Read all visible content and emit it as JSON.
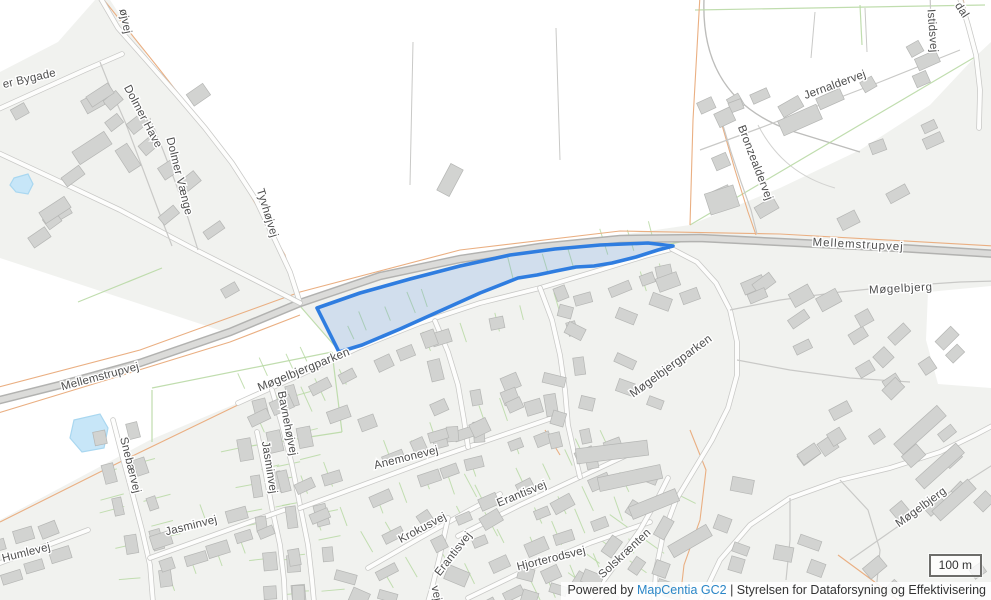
{
  "map": {
    "highlight": {
      "stroke_color": "#2f7de0",
      "fill_color": "rgba(51,122,230,0.17)",
      "polygon": [
        [
          317,
          308
        ],
        [
          360,
          293
        ],
        [
          410,
          279
        ],
        [
          460,
          266
        ],
        [
          510,
          255
        ],
        [
          555,
          249
        ],
        [
          600,
          245
        ],
        [
          648,
          243
        ],
        [
          673,
          246
        ],
        [
          658,
          250
        ],
        [
          636,
          257
        ],
        [
          612,
          263
        ],
        [
          594,
          266
        ],
        [
          576,
          267
        ],
        [
          556,
          271
        ],
        [
          537,
          275
        ],
        [
          518,
          278
        ],
        [
          480,
          293
        ],
        [
          440,
          311
        ],
        [
          400,
          329
        ],
        [
          362,
          345
        ],
        [
          339,
          352
        ]
      ]
    },
    "palette": {
      "background": "#f1f2ef",
      "field": "#ffffff",
      "building_fill": "#d2d3d1",
      "building_stroke": "#b5b6b4",
      "road_major_fill": "#dbdbd9",
      "road_major_casing": "#b2b2b0",
      "road_minor_casing": "#c8c8c6",
      "hedge_green": "#b9d9a5",
      "path_orange": "#eaaf82",
      "water_fill": "#c7e6f8",
      "water_stroke": "#a9d7f0",
      "label_color": "#4e4e4e"
    },
    "labels": [
      {
        "text": "øjvej",
        "x": 122,
        "y": 22,
        "r": 78,
        "s": 11.5
      },
      {
        "text": "er Bygade",
        "x": 30,
        "y": 82,
        "r": -13,
        "s": 11.5
      },
      {
        "text": "Dolmer Have",
        "x": 140,
        "y": 118,
        "r": 62,
        "s": 11.5
      },
      {
        "text": "Dolmer Vænge",
        "x": 176,
        "y": 177,
        "r": 76,
        "s": 11.5
      },
      {
        "text": "Tyvhøjvej",
        "x": 264,
        "y": 214,
        "r": 73,
        "s": 11.5
      },
      {
        "text": "Mellemstrupvej",
        "x": 101,
        "y": 380,
        "r": -15,
        "s": 11.5
      },
      {
        "text": "Mellemstrupvej",
        "x": 858,
        "y": 248,
        "r": 3,
        "s": 11.5,
        "ls": 1
      },
      {
        "text": "Møgelbjergparken",
        "x": 305,
        "y": 373,
        "r": -22,
        "s": 11.8
      },
      {
        "text": "Møgelbjergparken",
        "x": 673,
        "y": 369,
        "r": -36,
        "s": 11.8
      },
      {
        "text": "Møgelbjerg",
        "x": 901,
        "y": 292,
        "r": -3,
        "s": 11.5,
        "ls": 0.6
      },
      {
        "text": "Møgelbjerg",
        "x": 923,
        "y": 510,
        "r": -36,
        "s": 11.5
      },
      {
        "text": "Jernaldervej",
        "x": 836,
        "y": 88,
        "r": -20,
        "s": 11.5
      },
      {
        "text": "Bronzealdervej",
        "x": 752,
        "y": 164,
        "r": 69,
        "s": 11.5
      },
      {
        "text": "Istidsvej",
        "x": 929,
        "y": 31,
        "r": 86,
        "s": 11.5
      },
      {
        "text": "dal",
        "x": 959,
        "y": 12,
        "r": 57,
        "s": 11.5
      },
      {
        "text": "Bavnehøjvej",
        "x": 284,
        "y": 424,
        "r": 79,
        "s": 11.5
      },
      {
        "text": "Snebærvej",
        "x": 127,
        "y": 466,
        "r": 76,
        "s": 11.5
      },
      {
        "text": "Jasminvej",
        "x": 266,
        "y": 468,
        "r": 81,
        "s": 11.5
      },
      {
        "text": "Jasminvej",
        "x": 192,
        "y": 529,
        "r": -14,
        "s": 11.5
      },
      {
        "text": "Humlevej",
        "x": 27,
        "y": 556,
        "r": -14,
        "s": 11.5
      },
      {
        "text": "Anemonevej",
        "x": 407,
        "y": 461,
        "r": -14,
        "s": 11.5
      },
      {
        "text": "Krokusvej",
        "x": 424,
        "y": 531,
        "r": -28,
        "s": 11.5
      },
      {
        "text": "Erantisvej",
        "x": 523,
        "y": 497,
        "r": -22,
        "s": 11.5
      },
      {
        "text": "Erantisvej",
        "x": 456,
        "y": 556,
        "r": -52,
        "s": 11.5
      },
      {
        "text": "Hjorterodsvej",
        "x": 552,
        "y": 562,
        "r": -14,
        "s": 11.5
      },
      {
        "text": "Solskrænten",
        "x": 627,
        "y": 556,
        "r": -43,
        "s": 11.5
      },
      {
        "text": "vej",
        "x": 433,
        "y": 594,
        "r": 78,
        "s": 11.5
      }
    ]
  },
  "scale_control": {
    "label": "100 m"
  },
  "attribution": {
    "powered_by": "Powered by",
    "link_label": "MapCentia GC2",
    "separator": "|",
    "agency": "Styrelsen for Dataforsyning og Effektivisering"
  }
}
